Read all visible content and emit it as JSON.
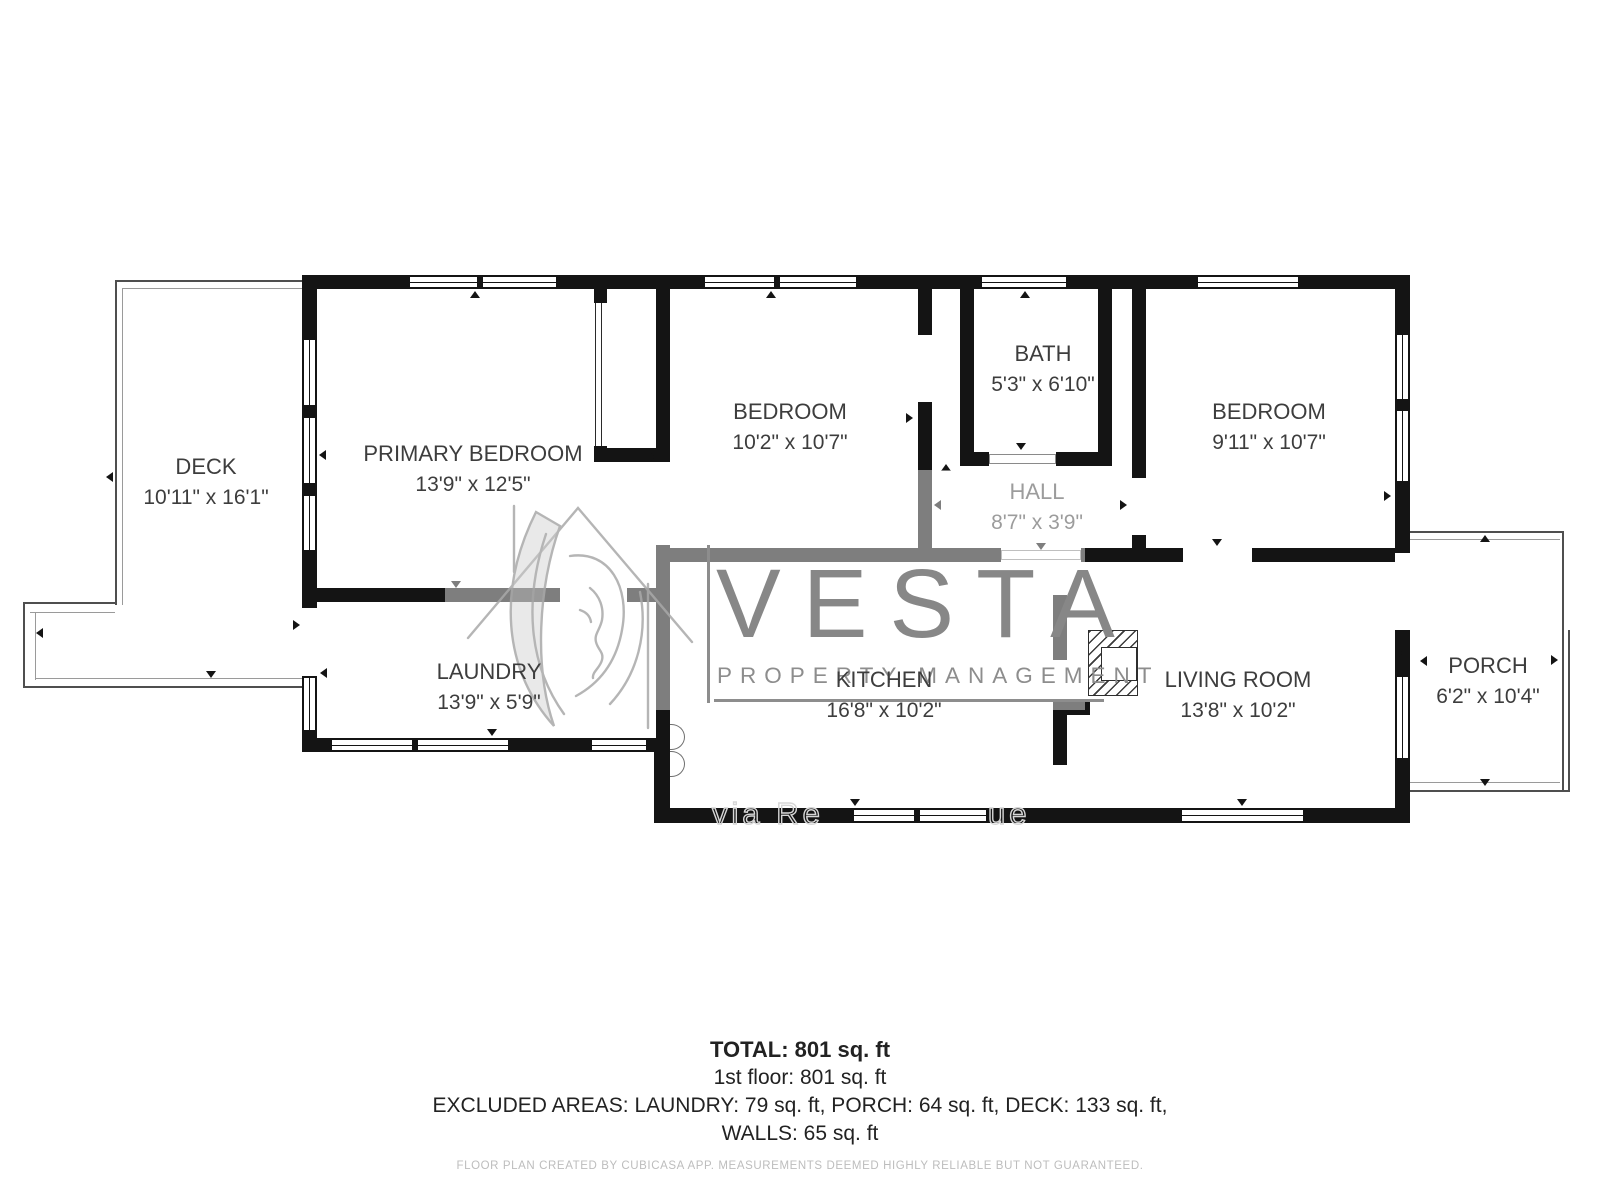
{
  "rooms": [
    {
      "id": "deck",
      "name": "DECK",
      "dims": "10'11\" x 16'1\""
    },
    {
      "id": "primary-bedroom",
      "name": "PRIMARY BEDROOM",
      "dims": "13'9\" x 12'5\""
    },
    {
      "id": "laundry",
      "name": "LAUNDRY",
      "dims": "13'9\" x 5'9\""
    },
    {
      "id": "bedroom-middle",
      "name": "BEDROOM",
      "dims": "10'2\" x 10'7\""
    },
    {
      "id": "bath",
      "name": "BATH",
      "dims": "5'3\" x 6'10\""
    },
    {
      "id": "hall",
      "name": "HALL",
      "dims": "8'7\" x 3'9\""
    },
    {
      "id": "bedroom-right",
      "name": "BEDROOM",
      "dims": "9'11\" x 10'7\""
    },
    {
      "id": "kitchen",
      "name": "KITCHEN",
      "dims": "16'8\" x 10'2\""
    },
    {
      "id": "living-room",
      "name": "LIVING ROOM",
      "dims": "13'8\" x 10'2\""
    },
    {
      "id": "porch",
      "name": "PORCH",
      "dims": "6'2\" x 10'4\""
    }
  ],
  "watermark": {
    "brand": "VESTA",
    "tagline": "PROPERTY MANAGEMENT",
    "credit_prefix": "via Re",
    "credit_suffix": "ue"
  },
  "summary": {
    "total": "TOTAL: 801 sq. ft",
    "floor1": "1st floor: 801 sq. ft",
    "excluded": "EXCLUDED AREAS: LAUNDRY: 79 sq. ft, PORCH: 64 sq. ft, DECK: 133 sq. ft,",
    "walls": "WALLS: 65 sq. ft"
  },
  "footer": {
    "disclaimer": "FLOOR PLAN CREATED BY CUBICASA APP. MEASUREMENTS DEEMED HIGHLY RELIABLE BUT NOT GUARANTEED."
  },
  "colors": {
    "wall": "#141414",
    "thin_line": "#4f4f4f",
    "label": "#3d3d3d",
    "muted_label": "#9c9c9c",
    "watermark": "#8d8d8d",
    "footer_text": "#bdbdbd"
  }
}
